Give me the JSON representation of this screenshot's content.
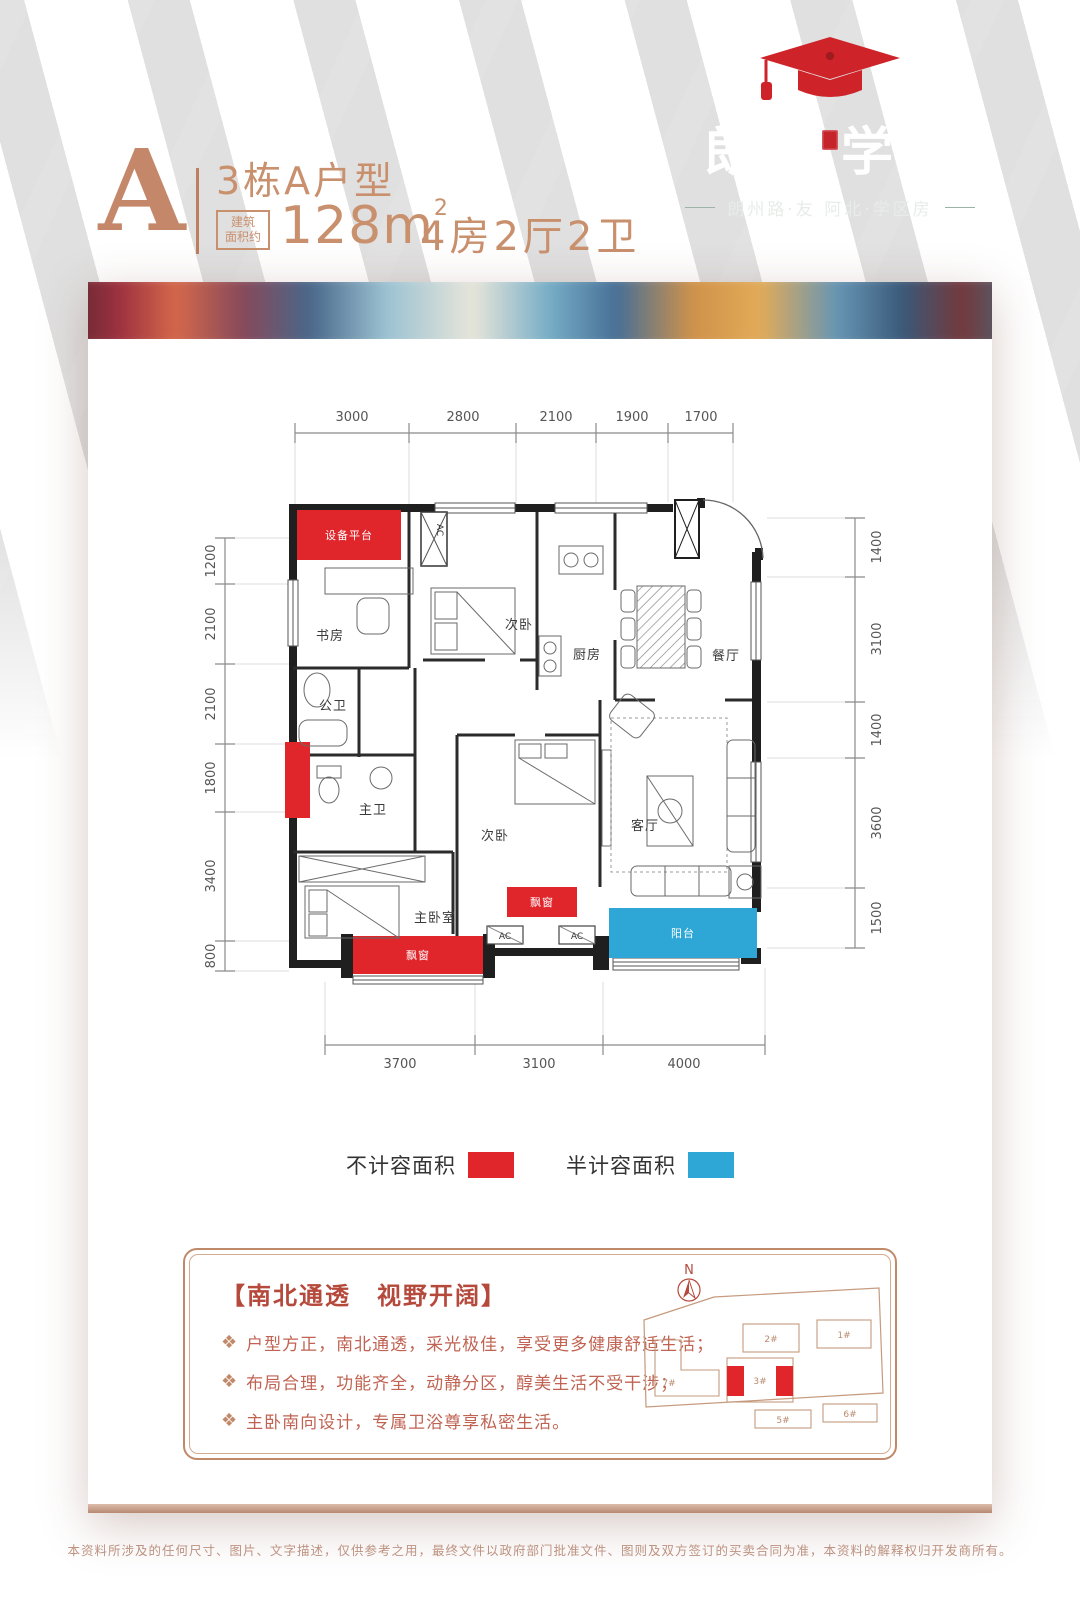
{
  "logo": {
    "name_left": "朗州",
    "name_right": "学府",
    "tagline": "朗州路·友 阿北·学区房"
  },
  "header": {
    "block_letter": "A",
    "unit_title": "3栋A户型",
    "area_badge_line1": "建筑",
    "area_badge_line2": "面积约",
    "area_value": "128m",
    "area_sup": "2",
    "rooms_summary": "4房2厅2卫"
  },
  "floorplan": {
    "colors": {
      "red": "#e0252b",
      "blue": "#2ea6d6"
    },
    "dims": {
      "top": [
        "3000",
        "2800",
        "2100",
        "1900",
        "1700"
      ],
      "left": [
        "1200",
        "2100",
        "2100",
        "1800",
        "3400",
        "800"
      ],
      "right": [
        "1400",
        "3100",
        "1400",
        "3600",
        "1500"
      ],
      "bottom": [
        "3700",
        "3100",
        "4000"
      ]
    },
    "rooms": {
      "equipment_platform": "设备平台",
      "study": "书房",
      "ac_shaft": "AC",
      "bedroom2": "次卧",
      "kitchen": "厨房",
      "dining": "餐厅",
      "guest_bath": "公卫",
      "master_bath": "主卫",
      "bedroom3": "次卧",
      "living": "客厅",
      "master_bedroom": "主卧室",
      "bay_window1": "飘窗",
      "bay_window2": "飘窗",
      "ac_unit1": "AC",
      "ac_unit2": "AC",
      "balcony": "阳台"
    }
  },
  "legend": {
    "items": [
      {
        "label": "不计容面积",
        "color": "#e0252b"
      },
      {
        "label": "半计容面积",
        "color": "#2ea6d6"
      }
    ]
  },
  "features": {
    "title": "【南北通透　视野开阔】",
    "bullets": [
      "户型方正，南北通透，采光极佳，享受更多健康舒适生活；",
      "布局合理，功能齐全，动静分区，醇美生活不受干涉；",
      "主卧南向设计，专属卫浴尊享私密生活。"
    ]
  },
  "siteplan": {
    "compass": "N",
    "buildings": {
      "b2": "2#",
      "b1": "1#",
      "b7": "7#",
      "b3": "3#",
      "b5": "5#",
      "b6": "6#"
    }
  },
  "footer": {
    "disclaimer": "本资料所涉及的任何尺寸、图片、文字描述，仅供参考之用，最终文件以政府部门批准文件、图则及双方签订的买卖合同为准，本资料的解释权归开发商所有。"
  }
}
